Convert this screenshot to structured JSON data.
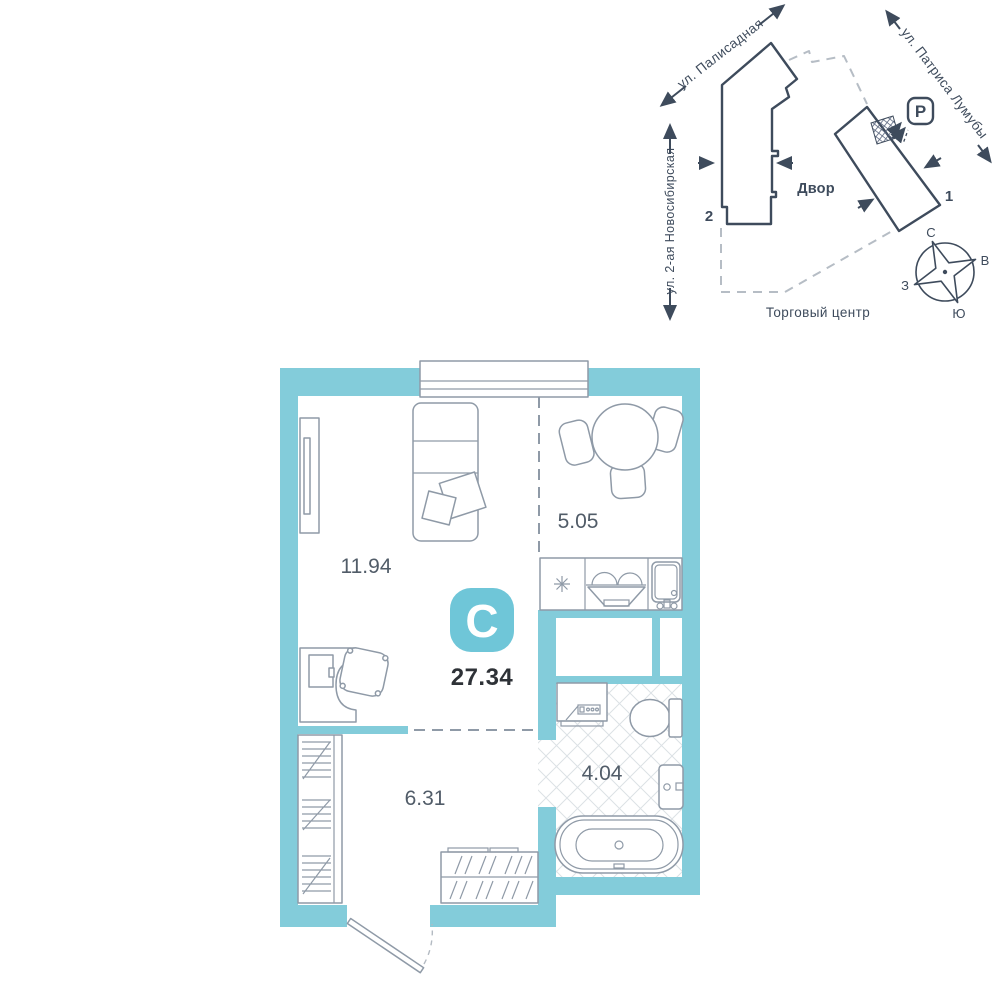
{
  "site_plan": {
    "streets": {
      "palisadnaya": "ул. Палисадная",
      "patrisa_lumumby": "ул. Патриса Лумубы",
      "novosibirskaya": "ул. 2-ая Новосибирская"
    },
    "courtyard": "Двор",
    "shopping_center": "Торговый центр",
    "building_1": "1",
    "building_2": "2",
    "parking": "P",
    "compass": {
      "n": "С",
      "e": "В",
      "s": "Ю",
      "w": "З"
    }
  },
  "floor_plan": {
    "badge": "С",
    "total_area": "27.34",
    "rooms": [
      {
        "name": "living room",
        "area": "11.94"
      },
      {
        "name": "kitchen",
        "area": "5.05"
      },
      {
        "name": "hallway",
        "area": "6.31"
      },
      {
        "name": "bathroom",
        "area": "4.04"
      }
    ]
  },
  "colors": {
    "wall": "#83ccda",
    "badge": "#6fc6d8",
    "dark": "#3e4b5c",
    "furniture": "#8f9aa7",
    "dashed": "#b6bdc5",
    "area_text": "#515c68",
    "total_text": "#2e3237"
  }
}
